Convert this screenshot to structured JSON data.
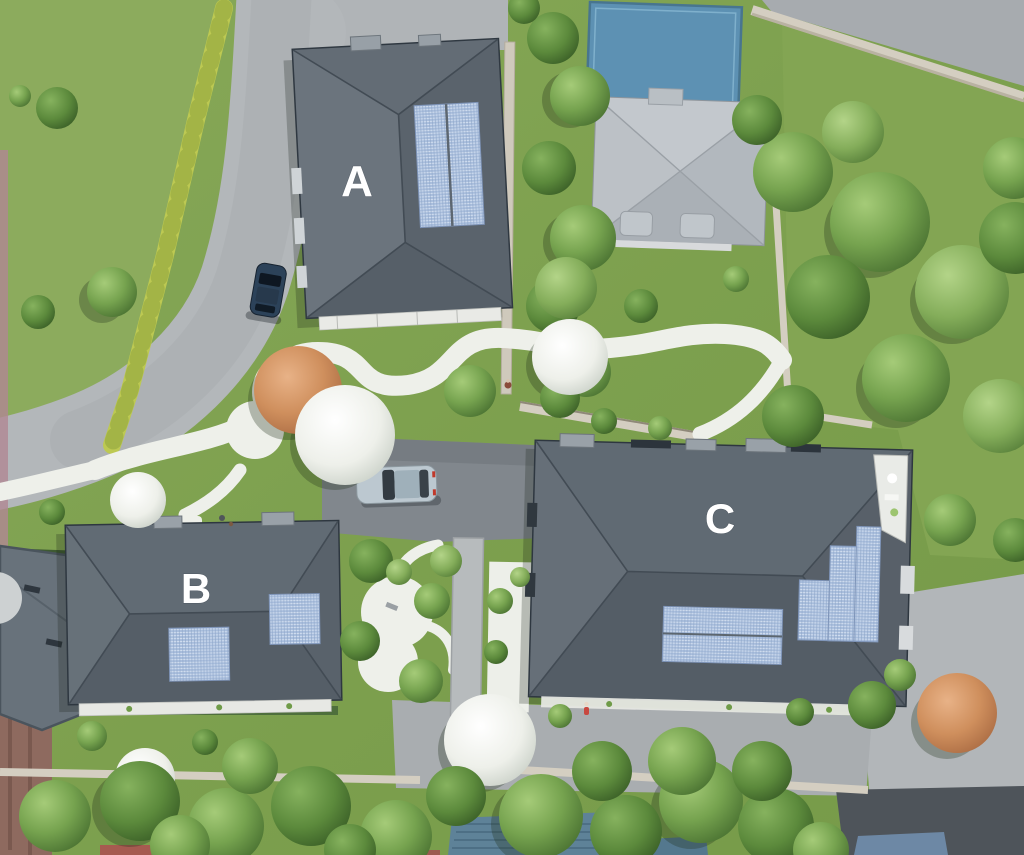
{
  "scene": {
    "type": "aerial-site-plan-render",
    "buildings": [
      {
        "id": "building-a",
        "label": "A"
      },
      {
        "id": "building-b",
        "label": "B"
      },
      {
        "id": "building-c",
        "label": "C"
      }
    ],
    "palette": {
      "grass": "#81A351",
      "roof_dark": "#5C666F",
      "roof_light": "#B8BEC4",
      "flat_roof_blue": "#5D91B3",
      "solar_panel": "#A9BEDD",
      "path_white": "#EFF0EA",
      "road_light": "#B3B7BA",
      "asphalt_parking": "#81878D",
      "asphalt_dark": "#4E545A",
      "stone_wall": "#D4CEC1",
      "hedge_yellow": "#BDC952",
      "tree_green": "#76A34F",
      "tree_autumn": "#CF8F5D",
      "tree_blossom": "#EEF0EA",
      "car_silver": "#BCC8D0",
      "car_navy": "#2C4259",
      "neighbor_roof_blue": "#5E8298",
      "neighbor_roof_red": "#A65A50"
    }
  }
}
